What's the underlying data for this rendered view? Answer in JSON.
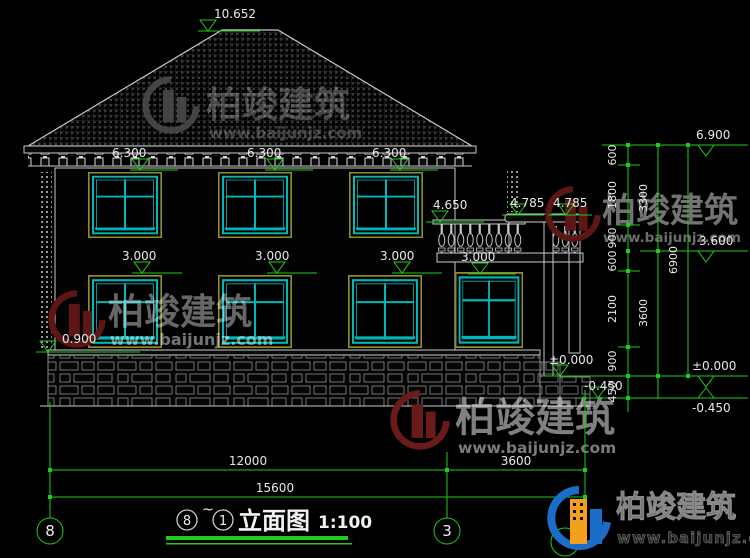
{
  "drawing": {
    "title": {
      "axis_start": "8",
      "separator": "~",
      "axis_end": "1",
      "name": "立面图",
      "scale": "1:100"
    },
    "axes": {
      "left_bubble": "8",
      "mid_bubble": "3"
    },
    "elevations": {
      "ridge": "10.652",
      "eave": [
        "6.300",
        "6.300",
        "6.300"
      ],
      "balcony_rail": "4.650",
      "canopy": [
        "4.785",
        "4.785"
      ],
      "window_head": [
        "3.000",
        "3.000",
        "3.000",
        "3.000"
      ],
      "window_sill": "0.900",
      "floor_left": "±0.000",
      "grade_left": "-0.450",
      "right_top": "6.900",
      "right_annex_roof": "3.600",
      "right_floor": "±0.000",
      "right_grade": "-0.450"
    },
    "dims": {
      "right_inner": [
        "600",
        "1800",
        "900",
        "600",
        "2100",
        "900",
        "450"
      ],
      "right_mid": [
        "3300",
        "3600"
      ],
      "right_total": "6900",
      "bottom_segments": [
        "12000",
        "3600"
      ],
      "bottom_total": "15600"
    }
  },
  "watermark": {
    "name": "柏竣建筑",
    "url": "www.baijunjz.com"
  },
  "brand": {
    "name": "柏竣建筑",
    "url": "www.baijunjz.com"
  },
  "colors": {
    "dim_green": "#1ecb1e",
    "window_cyan": "#00b8b8",
    "frame_olive": "#8f8f2a",
    "line_white": "#c9c9c9",
    "brand_blue": "#1b6ec8",
    "brand_orange": "#f5a01d",
    "watermark_red": "#5c1616"
  }
}
